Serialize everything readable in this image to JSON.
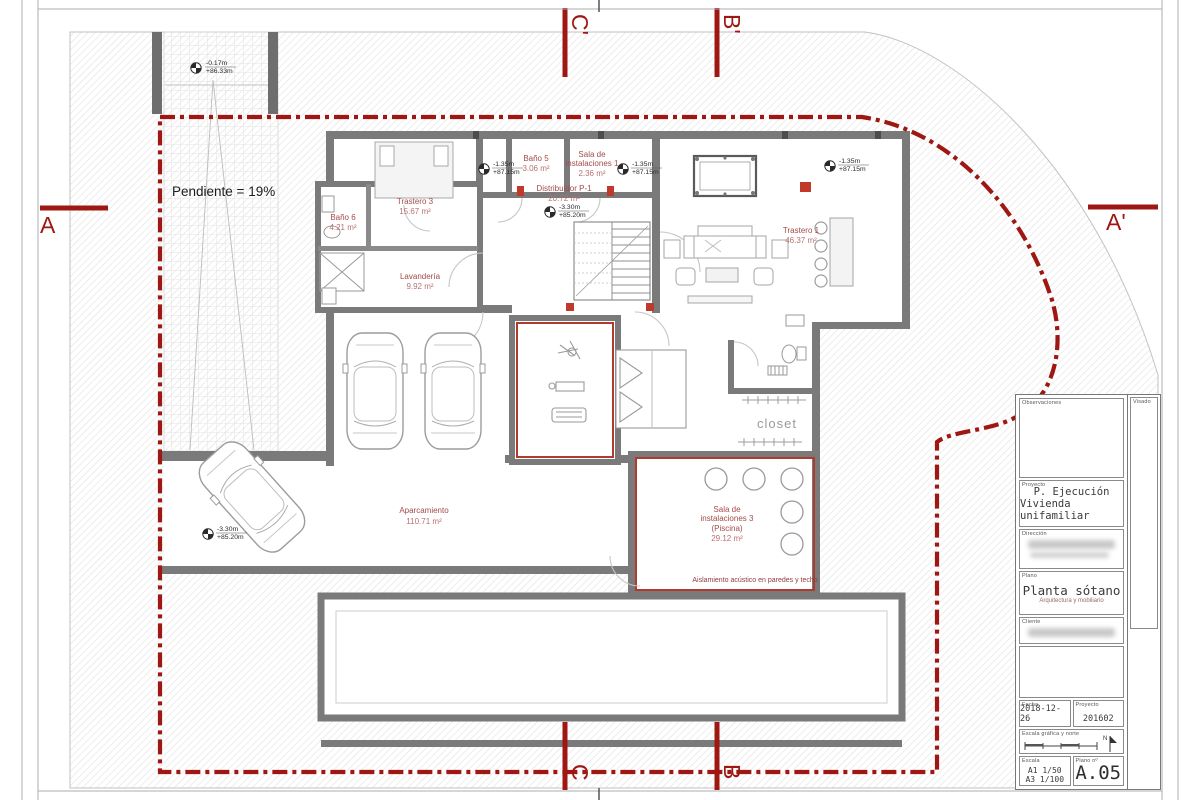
{
  "plan": {
    "pendiente": "Pendiente = 19%",
    "closet": "closet",
    "aislamiento": "Aislamiento acústico en paredes y techo"
  },
  "rooms": {
    "trastero3": {
      "name": "Trastero 3",
      "area": "15.67 m²"
    },
    "bano5": {
      "name": "Baño 5",
      "area": "3.06 m²"
    },
    "sala1": {
      "l1": "Sala de",
      "l2": "instalaciones 1",
      "area": "2.36 m²"
    },
    "distribuidor": {
      "name": "Distribuidor P-1",
      "area": "20.72 m²"
    },
    "trastero1": {
      "name": "Trastero 1",
      "area": "46.37 m²"
    },
    "bano6": {
      "name": "Baño 6",
      "area": "4.21 m²"
    },
    "lavanderia": {
      "name": "Lavandería",
      "area": "9.92 m²"
    },
    "aparcamiento": {
      "name": "Aparcamiento",
      "area": "110.71 m²"
    },
    "sala3": {
      "l1": "Sala de",
      "l2": "instalaciones 3",
      "l3": "(Piscina)",
      "area": "29.12 m²"
    }
  },
  "levels": {
    "top": {
      "a": "-0.17m",
      "b": "+86.33m"
    },
    "mid": {
      "a": "-1.35m",
      "b": "+87.15m"
    },
    "low": {
      "a": "-3.30m",
      "b": "+85.20m"
    }
  },
  "sections": {
    "a": "A",
    "a2": "A'",
    "b": "B",
    "b2": "B'",
    "c": "C",
    "c2": "C'"
  },
  "titleblock": {
    "observaciones_label": "Observaciones",
    "visado_label": "Visado",
    "proyecto_label": "Proyecto",
    "proyecto_line1": "P. Ejecución",
    "proyecto_line2": "Vivienda unifamiliar",
    "direccion_label": "Dirección",
    "plano_label": "Plano",
    "plano_title": "Planta sótano",
    "plano_subtitle": "Arquitectura y mobiliario",
    "cliente_label": "Cliente",
    "fecha_label": "Fecha",
    "fecha": "2018-12-26",
    "num_label": "Proyecto",
    "num": "201602",
    "escala_grafica_label": "Escala gráfica y norte",
    "north": "N",
    "escala_label": "Escala",
    "escala_1": "A1 1/50",
    "escala_2": "A3 1/100",
    "plano_no_label": "Plano nº",
    "sheet": "A.05"
  },
  "colors": {
    "boundary_red": "#9e1712",
    "label_red": "#a34a4a",
    "wall_gray": "#7a7a7a"
  }
}
